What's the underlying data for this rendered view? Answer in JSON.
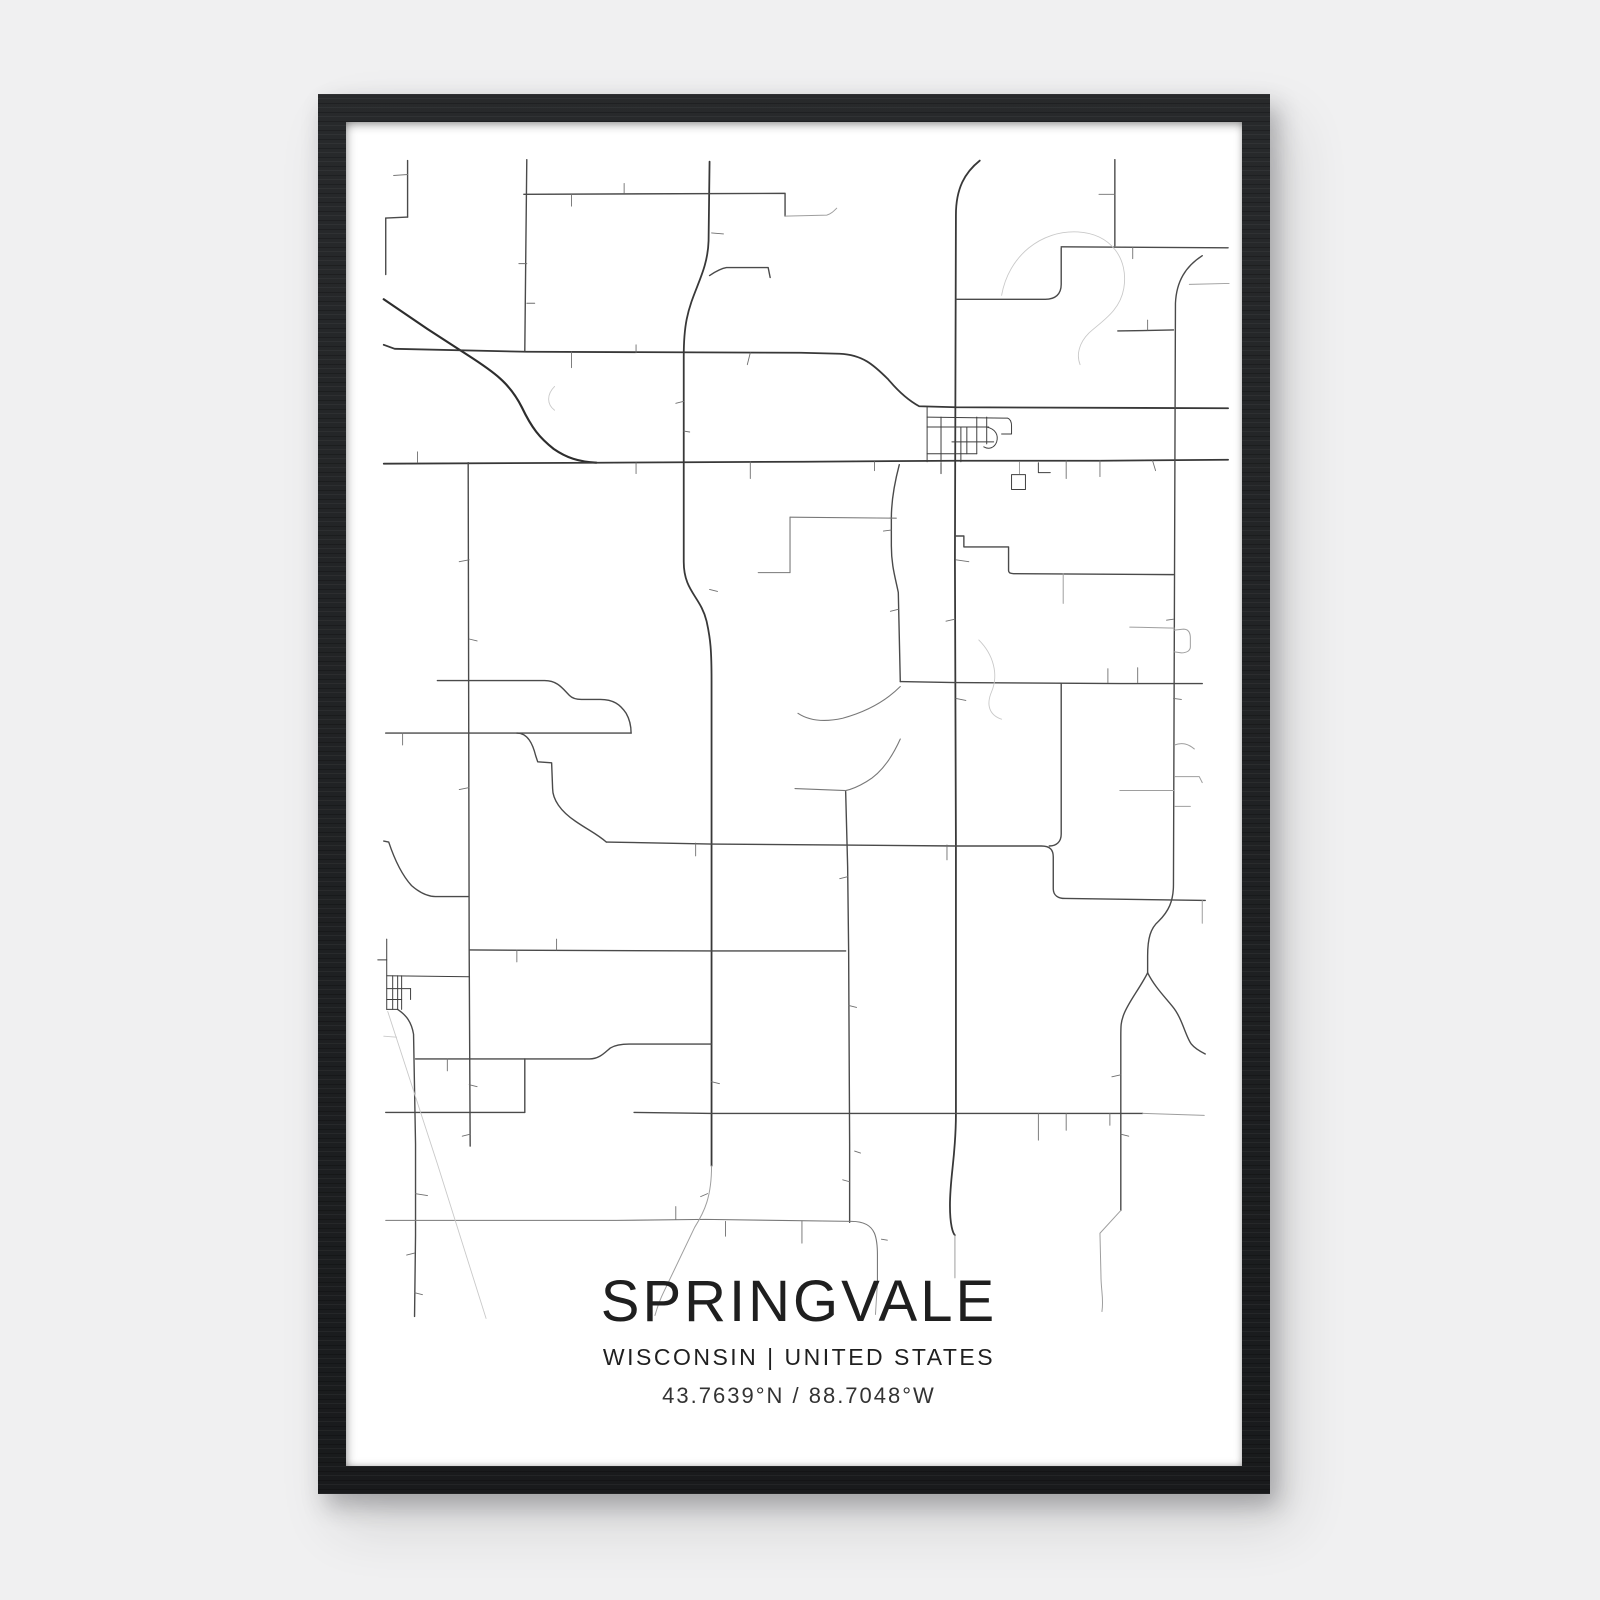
{
  "poster": {
    "title": "SPRINGVALE",
    "subtitle": "WISCONSIN | UNITED STATES",
    "coordinates": "43.7639°N / 88.7048°W"
  },
  "colors": {
    "page_bg": "#f0f0f1",
    "frame": "#1c1e20",
    "paper": "#ffffff",
    "text": "#1f1f1f",
    "road_highway": "#2d2d2d",
    "road_major": "#383838",
    "road_medium": "#4a4a4a",
    "road_minor": "#787878",
    "road_light": "#9e9e9e",
    "road_faint": "#c9c9c9",
    "road_grid": "#3f3f3f",
    "road_tick": "#6f6f6f"
  },
  "map": {
    "viewBox": "348 118 902 1357",
    "roads": [
      {
        "c": "highway",
        "d": "M386,297 L430,327 L470,353 C498,371 513,382 525,406 C535,427 543,437 557,448 C570,457 582,461 600,462"
      },
      {
        "c": "major",
        "d": "M386,463 L598,462 L808,461 L962,460 L1107,460 L1236,459"
      },
      {
        "c": "major",
        "d": "M986,157 C971,169 962,185 962,212 L961,560 L962,847 L962,1120 C962,1162 956,1182 956,1212 C956,1232 959,1240 961,1242"
      },
      {
        "c": "major",
        "d": "M714,158 L713,238 C712,270 697,287 691,317 C689,327 688,340 688,355 L688,462 L688,562 C688,592 705,597 711,622 C715,640 716,652 716,682 L716,1048 L716,1172"
      },
      {
        "c": "major",
        "d": "M386,343 L397,347 L530,350 L806,351 L845,352 C868,353 879,363 894,378 C904,390 914,399 925,405 L962,406 L1236,407"
      },
      {
        "c": "road",
        "d": "M530,156 L529,250 L528,349"
      },
      {
        "c": "road",
        "d": "M527,191 L790,190 L790,213"
      },
      {
        "c": "road",
        "d": "M1122,156 L1122,243"
      },
      {
        "c": "road",
        "d": "M1068,244 L1236,245"
      },
      {
        "c": "road",
        "d": "M962,297 L1052,297 C1062,297 1068,292 1068,282 L1068,245"
      },
      {
        "c": "road",
        "d": "M1210,253 C1193,264 1184,279 1183,301 L1181,888 C1181,905 1176,915 1166,925 C1158,932 1155,942 1155,960 L1155,977"
      },
      {
        "c": "road",
        "d": "M1155,977 C1147,993 1136,1006 1131,1019 C1128,1027 1128,1030 1128,1042 L1128,1217"
      },
      {
        "c": "road",
        "d": "M1155,977 C1162,991 1172,1001 1180,1011 C1190,1023 1193,1041 1199,1049 C1203,1054 1209,1057 1213,1059"
      },
      {
        "c": "road",
        "d": "M471,462 L472,952 L473,1152"
      },
      {
        "c": "road",
        "d": "M400,1014 C409,1020 414,1027 416,1039 L418,1150 L418,1242 L417,1324"
      },
      {
        "c": "road",
        "d": "M906,683 L961,684 L1128,685 L1210,685"
      },
      {
        "c": "road",
        "d": "M1068,685 L1068,837 C1068,845 1063,849 1056,849"
      },
      {
        "c": "road",
        "d": "M610,845 L716,847 L850,848 L962,849 L1048,849 C1057,849 1060,853 1060,860 L1060,892 C1060,899 1065,902 1072,902 L1213,904"
      },
      {
        "c": "road",
        "d": "M520,735 C531,735 536,746 539,758 L541,764 L555,765 L556,791 C556,802 564,814 579,824 C592,833 601,837 610,845"
      },
      {
        "c": "road",
        "d": "M388,735 L635,735"
      },
      {
        "c": "road",
        "d": "M440,682 L548,682 C561,682 566,690 573,697 C576,700 580,701 585,701 L604,701 C617,701 624,706 630,715 C634,722 635,728 635,735"
      },
      {
        "c": "road",
        "d": "M472,954 L716,955 L851,955"
      },
      {
        "c": "road",
        "d": "M905,464 C900,483 897,501 897,518 L897,546 C897,566 901,578 904,593 L906,683"
      },
      {
        "c": "road",
        "d": "M851,794 L853,870 L854,955 L855,1150 L855,1229"
      },
      {
        "c": "road",
        "d": "M418,1064 L593,1064 C603,1064 608,1058 614,1053 C619,1050 626,1049 633,1049 L716,1049"
      },
      {
        "c": "road",
        "d": "M388,1118 L528,1118"
      },
      {
        "c": "road",
        "d": "M528,1064 L528,1118"
      },
      {
        "c": "road",
        "d": "M638,1118 L716,1119 L855,1119 L962,1119 L1045,1119 L1150,1119"
      },
      {
        "c": "road",
        "d": "M962,536 L970,536 L970,547 L1015,547 L1015,571 C1015,573 1017,574 1020,574 L1181,575"
      },
      {
        "c": "road",
        "d": "M410,157 L410,214"
      },
      {
        "c": "road",
        "d": "M388,215 L410,214"
      },
      {
        "c": "road",
        "d": "M388,215 L388,272"
      },
      {
        "c": "road",
        "d": "M1125,329 L1181,328"
      },
      {
        "c": "road",
        "d": "M714,273 C720,269 725,266 731,265 L773,265 L775,275"
      },
      {
        "c": "road",
        "d": "M386,844 L391,845 C397,863 404,878 414,889 C422,896 430,900 438,900 L471,900"
      },
      {
        "c": "minor",
        "d": "M388,1227 L620,1227 L710,1226 L857,1228 C870,1228 877,1233 880,1240 C882,1245 883,1252 883,1262 L883,1290"
      },
      {
        "c": "minor",
        "d": "M795,517 L902,518"
      },
      {
        "c": "minor",
        "d": "M795,517 L795,573"
      },
      {
        "c": "minor",
        "d": "M763,573 L795,573"
      },
      {
        "c": "minor",
        "d": "M800,791 L851,793"
      },
      {
        "c": "minor",
        "d": "M396,172 L410,171"
      },
      {
        "c": "minor",
        "d": "M906,688 C890,704 870,714 848,720 C830,724 815,723 803,715"
      },
      {
        "c": "minor",
        "d": "M906,741 C897,761 886,776 872,784 C862,790 856,792 851,793"
      },
      {
        "c": "light",
        "d": "M790,213 L832,212 C836,211 839,208 842,205"
      },
      {
        "c": "light",
        "d": "M1197,282 L1237,281"
      },
      {
        "c": "light",
        "d": "M1137,628 L1182,629"
      },
      {
        "c": "light",
        "d": "M1182,631 L1191,630 C1196,630 1198,633 1198,639 L1198,648 C1198,652 1194,654 1189,654 L1182,653"
      },
      {
        "c": "light",
        "d": "M1182,747 C1190,744 1196,746 1202,751"
      },
      {
        "c": "light",
        "d": "M1182,779 L1207,779 L1210,785"
      },
      {
        "c": "light",
        "d": "M1127,793 L1182,793"
      },
      {
        "c": "light",
        "d": "M1182,809 L1198,809"
      },
      {
        "c": "light",
        "d": "M1070,574 L1070,604"
      },
      {
        "c": "light",
        "d": "M1210,904 L1210,927"
      },
      {
        "c": "light",
        "d": "M883,1290 L881,1322"
      },
      {
        "c": "light",
        "d": "M716,1172 C716,1203 709,1218 699,1234 L668,1299 C664,1307 661,1316 659,1323"
      },
      {
        "c": "light",
        "d": "M961,1242 L961,1285"
      },
      {
        "c": "light",
        "d": "M1128,1217 L1107,1240 L1108,1282 C1108,1298 1111,1306 1109,1319"
      },
      {
        "c": "light",
        "d": "M1150,1119 L1212,1121"
      },
      {
        "c": "light",
        "d": "M1026,461 L1026,473"
      },
      {
        "c": "faint",
        "d": "M1008,293 C1015,253 1048,227 1085,229 C1118,231 1136,256 1131,286 C1127,309 1109,319 1096,331 C1086,341 1083,353 1087,363"
      },
      {
        "c": "faint",
        "d": "M985,641 C1000,656 1005,676 998,693 C992,707 996,717 1008,721"
      },
      {
        "c": "faint",
        "d": "M558,385 C550,393 550,403 558,409"
      },
      {
        "c": "faint",
        "d": "M390,1016 L440,1170 L489,1326"
      },
      {
        "c": "faint",
        "d": "M386,1041 L399,1042"
      },
      {
        "c": "grid",
        "d": "M933,406 L933,461"
      },
      {
        "c": "grid",
        "d": "M947,416 L947,461"
      },
      {
        "c": "grid",
        "d": "M967,426 L967,461"
      },
      {
        "c": "grid",
        "d": "M973,426 L973,453"
      },
      {
        "c": "grid",
        "d": "M983,416 L983,453"
      },
      {
        "c": "grid",
        "d": "M993,416 L993,443"
      },
      {
        "c": "grid",
        "d": "M933,416 L1010,417 L1014,417 C1017,418 1018,421 1018,425 L1018,433 L1008,433"
      },
      {
        "c": "grid",
        "d": "M933,426 L995,426"
      },
      {
        "c": "grid",
        "d": "M958,441 L1000,441"
      },
      {
        "c": "grid",
        "d": "M933,453 L983,453"
      },
      {
        "c": "grid",
        "d": "M993,426 C1002,428 1005,434 1003,441 C1001,447 995,449 990,446"
      },
      {
        "c": "grid",
        "d": "M947,462 L947,473"
      },
      {
        "c": "grid",
        "d": "M1018,474 L1032,474 L1032,489 L1018,489 Z"
      },
      {
        "c": "grid",
        "d": "M1045,462 L1045,472 L1057,472"
      },
      {
        "c": "grid",
        "d": "M389,943 L389,1014"
      },
      {
        "c": "grid",
        "d": "M395,980 L395,1014"
      },
      {
        "c": "grid",
        "d": "M400,980 L400,1014"
      },
      {
        "c": "grid",
        "d": "M404,980 L404,1014"
      },
      {
        "c": "grid",
        "d": "M389,980 L472,981"
      },
      {
        "c": "grid",
        "d": "M389,993 L413,993"
      },
      {
        "c": "grid",
        "d": "M389,1004 L404,1004"
      },
      {
        "c": "grid",
        "d": "M389,1014 L400,1014"
      },
      {
        "c": "grid",
        "d": "M413,993 L413,1004"
      },
      {
        "c": "grid",
        "d": "M380,964 L389,964"
      }
    ],
    "ticks": [
      [
        575,
        350,
        575,
        366
      ],
      [
        640,
        351,
        640,
        343
      ],
      [
        755,
        351,
        752,
        363
      ],
      [
        420,
        462,
        420,
        451
      ],
      [
        640,
        462,
        640,
        473
      ],
      [
        755,
        461,
        755,
        478
      ],
      [
        880,
        461,
        880,
        470
      ],
      [
        1073,
        460,
        1073,
        478
      ],
      [
        1107,
        460,
        1107,
        476
      ],
      [
        1160,
        460,
        1163,
        470
      ],
      [
        530,
        261,
        522,
        261
      ],
      [
        530,
        301,
        538,
        301
      ],
      [
        472,
        560,
        462,
        562
      ],
      [
        472,
        640,
        480,
        642
      ],
      [
        472,
        790,
        462,
        792
      ],
      [
        472,
        1090,
        480,
        1092
      ],
      [
        473,
        1140,
        465,
        1142
      ],
      [
        716,
        230,
        728,
        231
      ],
      [
        714,
        590,
        722,
        592
      ],
      [
        716,
        1087,
        724,
        1089
      ],
      [
        712,
        1200,
        705,
        1203
      ],
      [
        962,
        560,
        975,
        562
      ],
      [
        961,
        620,
        952,
        622
      ],
      [
        962,
        700,
        972,
        702
      ],
      [
        1115,
        684,
        1115,
        670
      ],
      [
        1145,
        684,
        1145,
        669
      ],
      [
        1122,
        191,
        1106,
        191
      ],
      [
        1140,
        244,
        1140,
        256
      ],
      [
        700,
        846,
        700,
        859
      ],
      [
        953,
        848,
        953,
        863
      ],
      [
        520,
        954,
        520,
        966
      ],
      [
        560,
        954,
        560,
        943
      ],
      [
        450,
        1064,
        450,
        1076
      ],
      [
        1045,
        1119,
        1045,
        1146
      ],
      [
        1073,
        1119,
        1073,
        1136
      ],
      [
        1117,
        1119,
        1117,
        1131
      ],
      [
        680,
        1226,
        680,
        1213
      ],
      [
        730,
        1228,
        730,
        1243
      ],
      [
        807,
        1228,
        807,
        1250
      ],
      [
        418,
        1200,
        430,
        1202
      ],
      [
        417,
        1260,
        409,
        1262
      ],
      [
        417,
        1300,
        425,
        1302
      ],
      [
        688,
        400,
        680,
        402
      ],
      [
        688,
        430,
        694,
        431
      ],
      [
        1181,
        620,
        1174,
        621
      ],
      [
        1181,
        700,
        1189,
        701
      ],
      [
        1155,
        328,
        1155,
        318
      ],
      [
        1128,
        1080,
        1119,
        1082
      ],
      [
        1128,
        1140,
        1136,
        1142
      ],
      [
        853,
        880,
        845,
        882
      ],
      [
        854,
        1010,
        862,
        1012
      ],
      [
        860,
        1157,
        866,
        1159
      ],
      [
        848,
        1186,
        855,
        1188
      ],
      [
        575,
        191,
        575,
        203
      ],
      [
        628,
        190,
        628,
        180
      ],
      [
        897,
        530,
        889,
        531
      ],
      [
        904,
        610,
        896,
        612
      ],
      [
        405,
        735,
        405,
        747
      ],
      [
        887,
        1246,
        893,
        1247
      ]
    ]
  }
}
